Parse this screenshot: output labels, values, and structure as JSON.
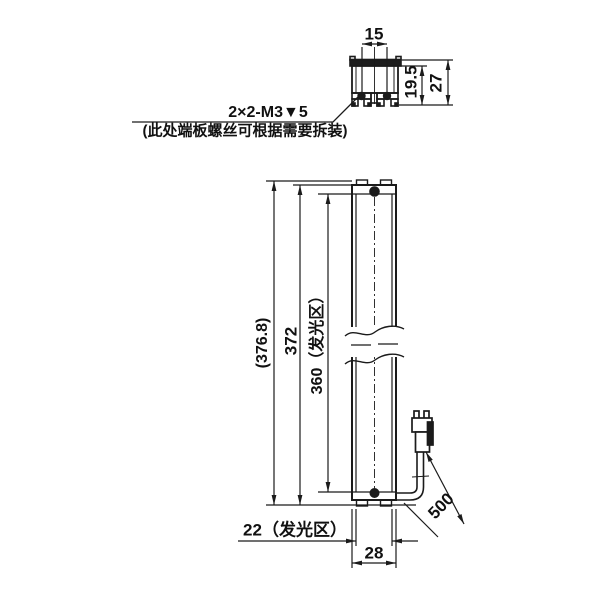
{
  "note": {
    "callout": "2×2-M3▼5",
    "description": "(此处端板螺丝可根据需要拆装)"
  },
  "section_view": {
    "slot_spacing": "15",
    "inner_height": "19.5",
    "overall_height": "27"
  },
  "front_view": {
    "overall_length_ref": "(376.8)",
    "body_length": "372",
    "emitting_length": "360（发光区）",
    "emitting_width": "22（发光区）",
    "overall_width": "28"
  },
  "cable": {
    "length": "500"
  },
  "colors": {
    "line": "#1b1b1b",
    "background": "#ffffff"
  }
}
